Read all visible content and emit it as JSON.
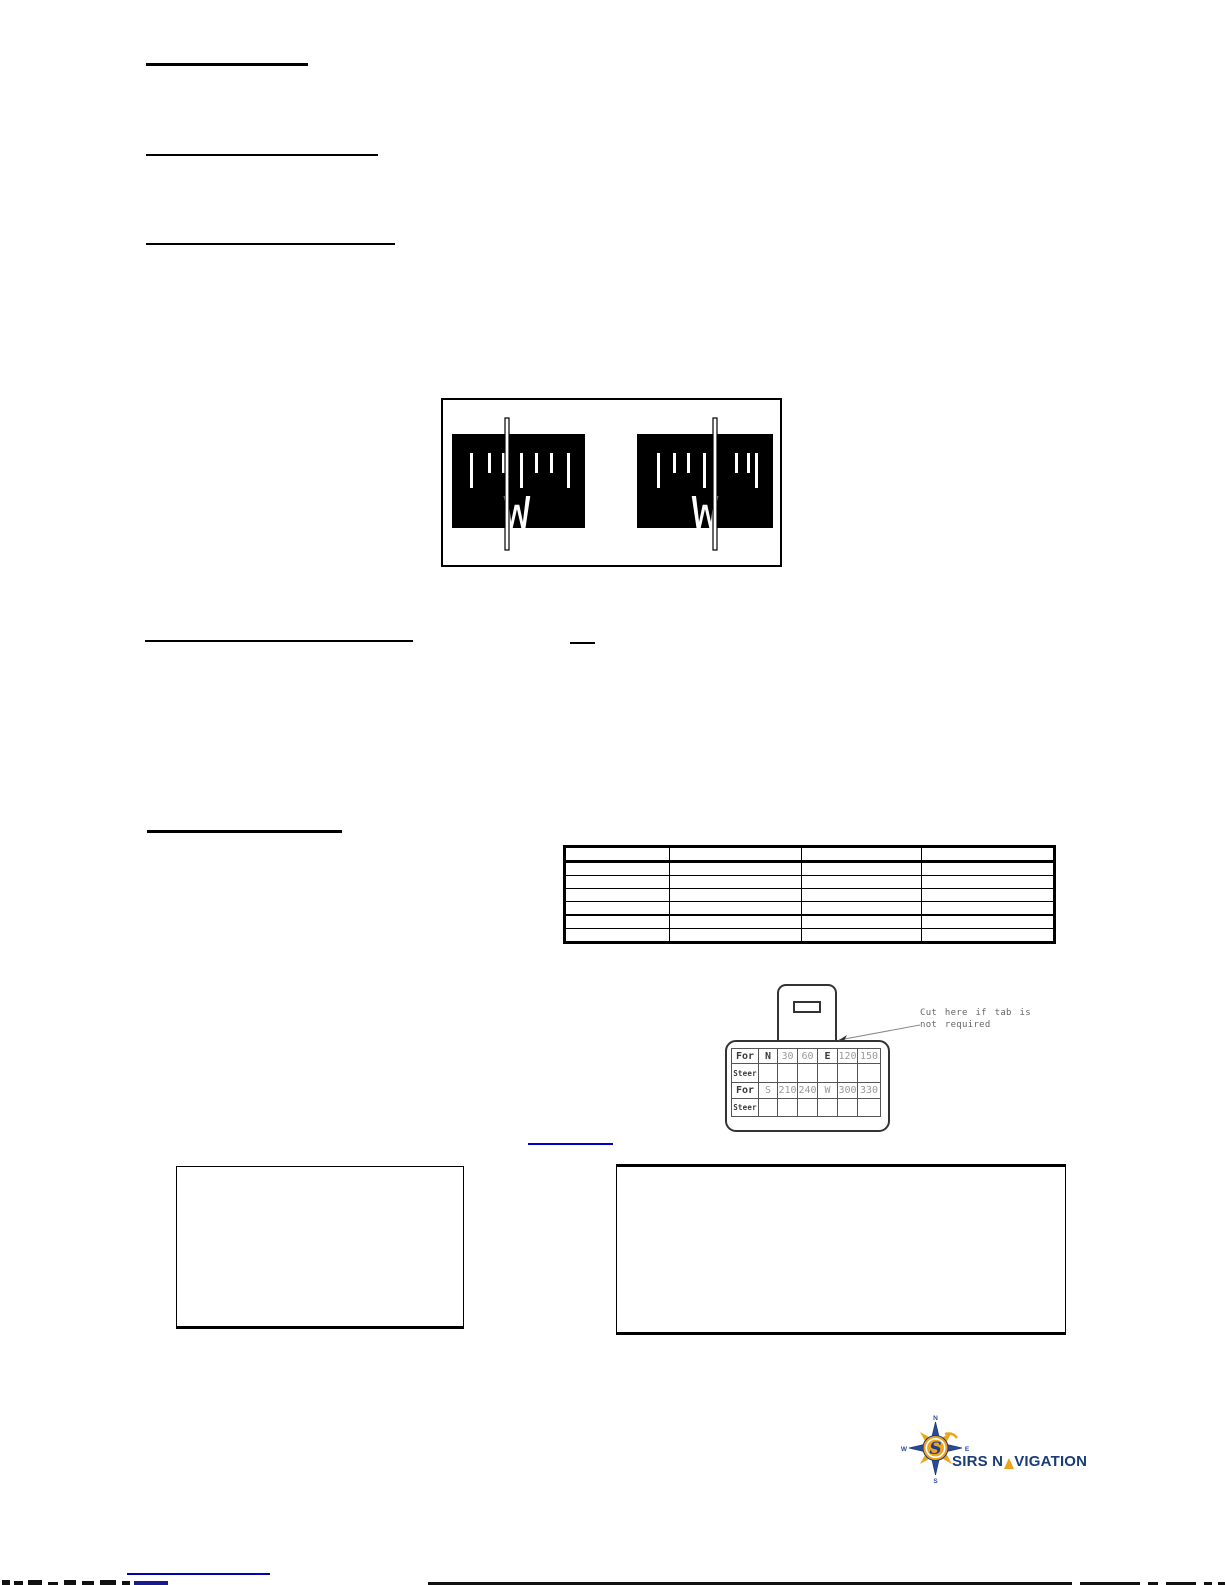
{
  "figure": {
    "left_card_letter": "W",
    "right_card_letter": "W"
  },
  "data_table": {
    "rows": [
      [
        "",
        "",
        "",
        ""
      ],
      [
        "",
        "",
        "",
        ""
      ],
      [
        "",
        "",
        "",
        ""
      ],
      [
        "",
        "",
        "",
        ""
      ],
      [
        "",
        "",
        "",
        ""
      ],
      [
        "",
        "",
        "",
        ""
      ],
      [
        "",
        "",
        "",
        ""
      ]
    ]
  },
  "steer_card": {
    "rows": [
      [
        "For",
        "N",
        "30",
        "60",
        "E",
        "120",
        "150"
      ],
      [
        "Steer",
        "",
        "",
        "",
        "",
        "",
        ""
      ],
      [
        "For",
        "S",
        "210",
        "240",
        "W",
        "300",
        "330"
      ],
      [
        "Steer",
        "",
        "",
        "",
        "",
        "",
        ""
      ]
    ],
    "dark_values": [
      "For",
      "Steer",
      "N",
      "E"
    ],
    "annotation_line1": "Cut here if tab is",
    "annotation_line2": "not required"
  },
  "logo": {
    "name": "SIRS NAVIGATION",
    "text_prefix": "SIRS N",
    "text_suffix": "VIGATION",
    "compass_letters": {
      "n": "N",
      "e": "E",
      "s": "S",
      "w": "W"
    },
    "letter_s": "S"
  },
  "colors": {
    "ink": "#000000",
    "link_blue": "#0000cc",
    "footer_link_blue": "#0000bb",
    "cad_gray": "#666666",
    "logo_navy": "#1a3c77",
    "logo_blue": "#2a4a9a",
    "logo_gold": "#eea31c"
  }
}
